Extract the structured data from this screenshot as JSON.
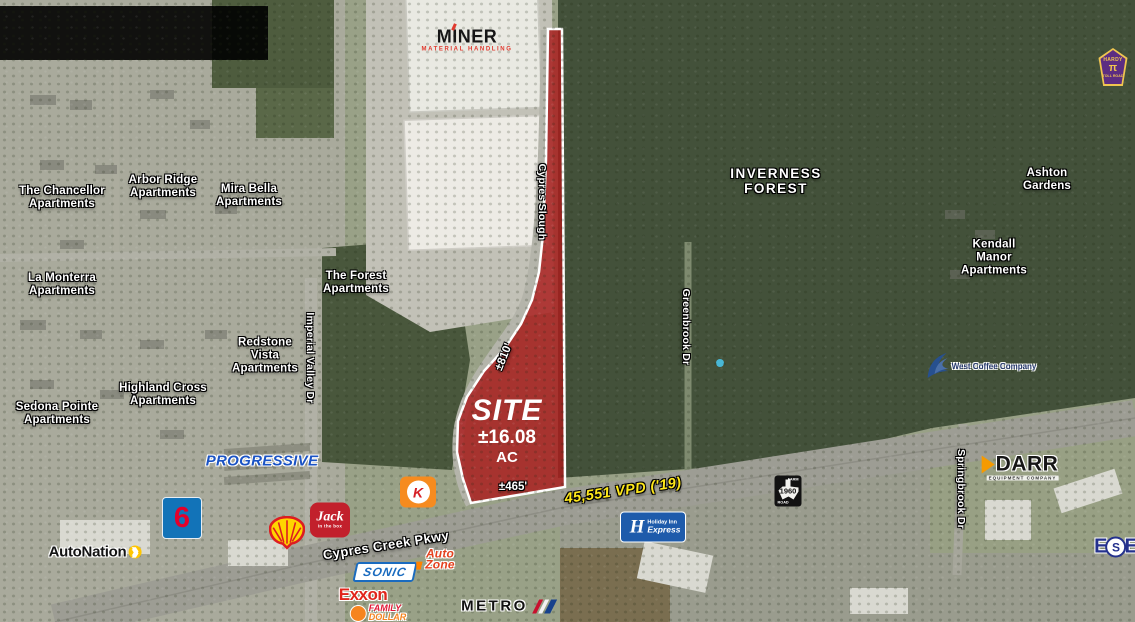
{
  "site": {
    "label": "SITE",
    "acreage": "±16.08",
    "unit": "AC",
    "depth": "±810'",
    "frontage": "±465'"
  },
  "traffic_count": "45,551 VPD ('19)",
  "roads": {
    "main": "Cypres Creek Pkwy",
    "slough": "Cypres Slough",
    "imperial": "Imperial Valley Dr",
    "greenbrook": "Greenbrook Dr",
    "springbrook": "Springbrook Dr"
  },
  "place_labels": [
    {
      "id": "the-chancellor-apartments",
      "text": "The Chancellor\nApartments",
      "x": 62,
      "y": 198
    },
    {
      "id": "arbor-ridge-apartments",
      "text": "Arbor Ridge\nApartments",
      "x": 163,
      "y": 187
    },
    {
      "id": "mira-bella-apartments",
      "text": "Mira Bella\nApartments",
      "x": 249,
      "y": 196
    },
    {
      "id": "la-monterra-apartments",
      "text": "La Monterra\nApartments",
      "x": 62,
      "y": 285
    },
    {
      "id": "the-forest-apartments",
      "text": "The Forest\nApartments",
      "x": 356,
      "y": 283
    },
    {
      "id": "redstone-vista-apartments",
      "text": "Redstone\nVista\nApartments",
      "x": 265,
      "y": 356
    },
    {
      "id": "highland-cross-apartments",
      "text": "Highland Cross\nApartments",
      "x": 163,
      "y": 395
    },
    {
      "id": "sedona-pointe-apartments",
      "text": "Sedona Pointe\nApartments",
      "x": 57,
      "y": 414
    },
    {
      "id": "kendall-manor-apartments",
      "text": "Kendall\nManor\nApartments",
      "x": 994,
      "y": 258
    },
    {
      "id": "ashton-gardens",
      "text": "Ashton\nGardens",
      "x": 1047,
      "y": 180
    },
    {
      "id": "inverness-forest",
      "text": "INVERNESS\nFOREST",
      "x": 776,
      "y": 181,
      "style": "area"
    }
  ],
  "road_labels": [
    {
      "id": "imperial-valley-dr",
      "text": "Imperial Valley Dr",
      "x": 309,
      "y": 358
    },
    {
      "id": "cypres-slough",
      "text": "Cypres Slough",
      "x": 541,
      "y": 202
    },
    {
      "id": "greenbrook-dr",
      "text": "Greenbrook Dr",
      "x": 685,
      "y": 327
    },
    {
      "id": "springbrook-dr",
      "text": "Springbrook Dr",
      "x": 960,
      "y": 489
    }
  ],
  "logos": {
    "miner": {
      "name": "MINER",
      "tagline": "MATERIAL HANDLING"
    },
    "hardy_toll_road": {
      "top": "HARDY",
      "glyph": "π",
      "bottom": "TOLL ROAD",
      "icon": "hardy-toll-road-shield-icon"
    },
    "west_coffee": {
      "text": "West Coffee Company",
      "icon": "eagle-wing-icon"
    },
    "darr": {
      "text": "DARR",
      "sub": "EQUIPMENT COMPANY"
    },
    "ese": {
      "left": "E",
      "mid": "S",
      "right": "E"
    },
    "farm_road_1960": {
      "top": "FARM",
      "number": "1960",
      "bottom": "ROAD",
      "icon": "texas-state-highway-sign-icon"
    },
    "holiday_inn_express": {
      "initial": "H",
      "line1": "Holiday Inn",
      "line2": "Express"
    },
    "progressive": {
      "text": "PROGRESSIVE"
    },
    "motel6": {
      "text": "6"
    },
    "autonation": {
      "text": "AutoNation",
      "arrow": "❯"
    },
    "shell": {
      "icon": "shell-pecten-icon"
    },
    "jack_in_the_box": {
      "script": "Jack",
      "sub": "in the box"
    },
    "circle_k": {
      "letter": "K"
    },
    "sonic": {
      "text": "SONIC"
    },
    "autozone": {
      "line1": "Auto",
      "line2": "Zone"
    },
    "exxon": {
      "text": "Exxon"
    },
    "family_dollar": {
      "line1": "FAMILY",
      "line2": "DOLLAR"
    },
    "metro": {
      "text": "METRO",
      "icon": "metro-stripes-icon"
    }
  },
  "colors": {
    "site_fill": "#a91d1d",
    "site_outline": "#ffffff",
    "traffic_text": "#ffe81a",
    "label_text": "#ffffff",
    "forest": "#43513a",
    "urban": "#a9aa9c"
  }
}
